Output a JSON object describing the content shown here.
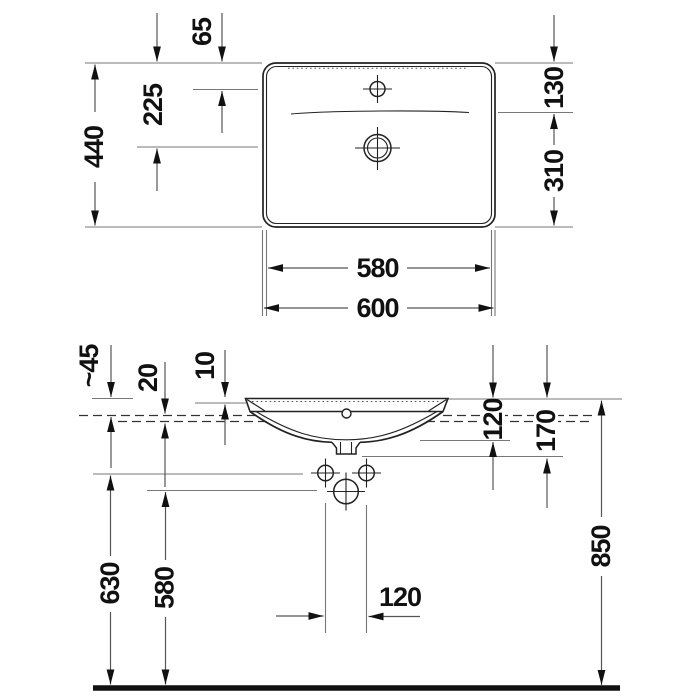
{
  "title": "washbasin technical drawing",
  "colors": {
    "line": "#222222",
    "dim_line": "#777777",
    "text": "#111111",
    "background": "#ffffff"
  },
  "labels": {
    "top_view": {
      "depth": "440",
      "drain_offset": "225",
      "faucet_offset": "65",
      "back_section": "130",
      "front_section": "310",
      "rim_width": "580",
      "outer_width": "600"
    },
    "front_view": {
      "rim_above_counter": "~45",
      "counter_thickness": "20",
      "rim_lip": "10",
      "bowl_depth": "120",
      "outlet_depth": "170",
      "rim_height": "850",
      "fixing_holes_height": "630",
      "drain_hole_height": "580",
      "fixing_holes_spacing": "120"
    }
  }
}
